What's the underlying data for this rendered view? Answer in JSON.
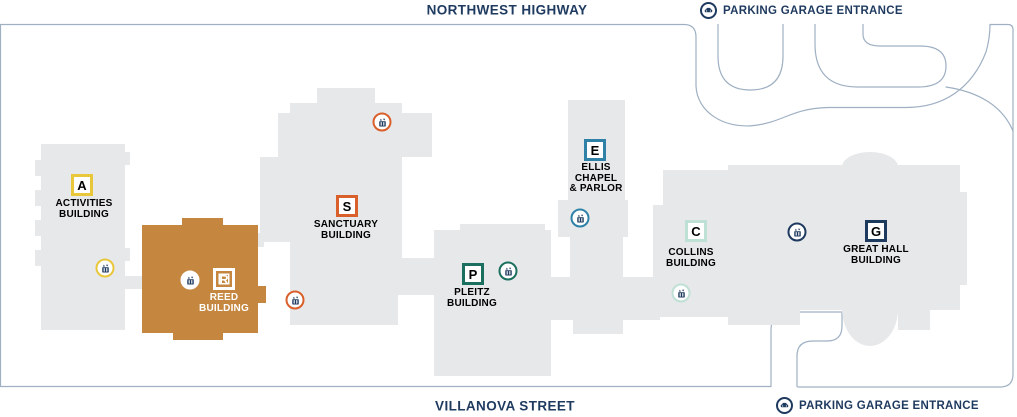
{
  "map": {
    "streets": {
      "top": "NORTHWEST HIGHWAY",
      "bottom": "VILLANOVA STREET"
    },
    "parking_entrance_label": "PARKING GARAGE ENTRANCE",
    "buildings": [
      {
        "letter": "A",
        "lines": [
          "ACTIVITIES",
          "BUILDING"
        ],
        "accent": "#e9c73b"
      },
      {
        "letter": "R",
        "lines": [
          "REED",
          "BUILDING"
        ],
        "accent": "#ffffff"
      },
      {
        "letter": "S",
        "lines": [
          "SANCTUARY",
          "BUILDING"
        ],
        "accent": "#d95f2b"
      },
      {
        "letter": "P",
        "lines": [
          "PLEITZ",
          "BUILDING"
        ],
        "accent": "#1b6f5f"
      },
      {
        "letter": "E",
        "lines": [
          "ELLIS",
          "CHAPEL",
          "& PARLOR"
        ],
        "accent": "#2f81a8"
      },
      {
        "letter": "C",
        "lines": [
          "COLLINS",
          "BUILDING"
        ],
        "accent": "#bfe0d4"
      },
      {
        "letter": "G",
        "lines": [
          "GREAT HALL",
          "BUILDING"
        ],
        "accent": "#1e3a5f"
      }
    ],
    "colors": {
      "navy": "#1e3a5f",
      "building_gray": "#e7e8ea",
      "reed_orange": "#c5873f",
      "road_line": "#9fb0c3",
      "white": "#ffffff"
    }
  }
}
